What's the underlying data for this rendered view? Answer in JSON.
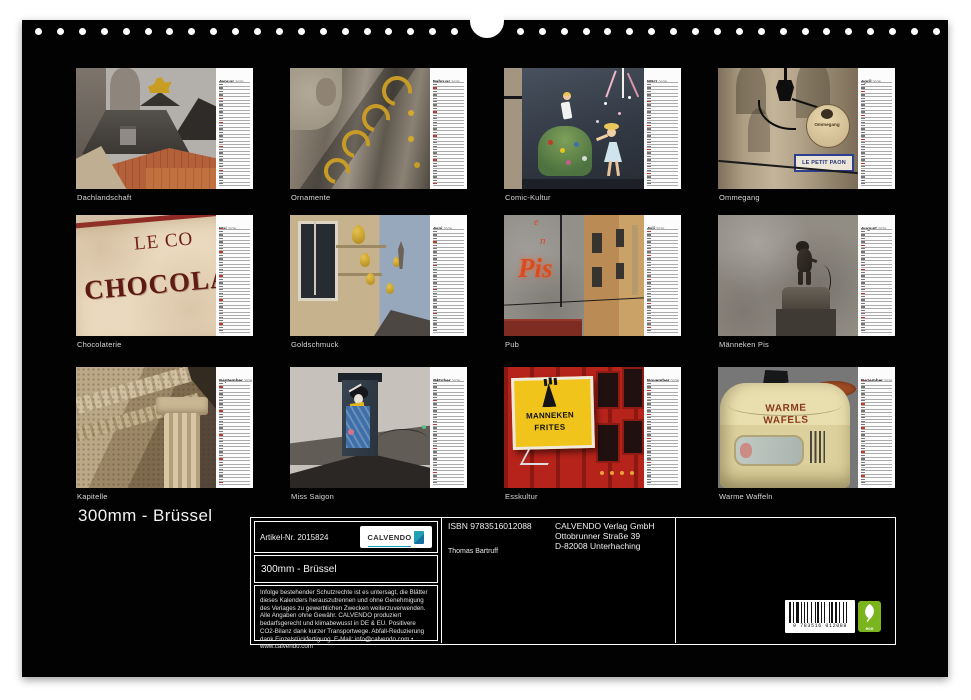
{
  "calendar": {
    "title": "300mm - Brüssel",
    "months": [
      {
        "name": "Januar",
        "year": "2026",
        "caption": "Dachlandschaft"
      },
      {
        "name": "Februar",
        "year": "2026",
        "caption": "Ornamente"
      },
      {
        "name": "März",
        "year": "2026",
        "caption": "Comic-Kultur"
      },
      {
        "name": "April",
        "year": "2026",
        "caption": "Ommegang",
        "signs": {
          "round": "Ommegang",
          "plate": "LE PETIT PAON"
        }
      },
      {
        "name": "Mai",
        "year": "2026",
        "caption": "Chocolaterie",
        "signs": {
          "line1": "LE CO",
          "line2": "CHOCOLA"
        }
      },
      {
        "name": "Juni",
        "year": "2026",
        "caption": "Goldschmuck"
      },
      {
        "name": "Juli",
        "year": "2026",
        "caption": "Pub",
        "signs": {
          "neon": "Pis",
          "small1": "e",
          "small2": "n"
        }
      },
      {
        "name": "August",
        "year": "2026",
        "caption": "Männeken Pis"
      },
      {
        "name": "September",
        "year": "2026",
        "caption": "Kapitelle"
      },
      {
        "name": "Oktober",
        "year": "2026",
        "caption": "Miss Saigon"
      },
      {
        "name": "November",
        "year": "2026",
        "caption": "Esskultur",
        "signs": {
          "line1": "MANNEKEN",
          "line2": "FRITES"
        }
      },
      {
        "name": "Dezember",
        "year": "2026",
        "caption": "Warme Waffeln",
        "signs": {
          "line1": "WARME",
          "line2": "WAFELS"
        }
      }
    ],
    "footer": {
      "article": "Artikel-Nr. 2015824",
      "product_title": "300mm - Brüssel",
      "brand": "CALVENDO",
      "legal": "Infolge bestehender Schutzrechte ist es untersagt, die Blätter dieses Kalenders herauszutrennen und ohne Genehmigung des Verlages zu gewerblichen Zwecken weiterzuverwenden. Alle Angaben ohne Gewähr. CALVENDO produziert bedarfsgerecht und klimabewusst in DE & EU. Positivere CO2-Bilanz dank kurzer Transportwege. Abfall-Reduzierung dank Einzelstückfertigung. E-Mail: info@calvendo.com • www.calvendo.com",
      "isbn": "ISBN 9783516012088",
      "publisher_lines": [
        "CALVENDO Verlag GmbH",
        "Ottobrunner Straße 39",
        "D-82008 Unterhaching"
      ],
      "author": "Thomas Bartruff",
      "barcode_digits": "9 783516 012088",
      "eco_label": "eco"
    },
    "colors": {
      "page_bg": "#000000",
      "backdrop": "#ffffff",
      "calvendo_teal": "#1a9cb0",
      "eco_green": "#7ab51d",
      "sunday_red": "#c0392b"
    }
  }
}
